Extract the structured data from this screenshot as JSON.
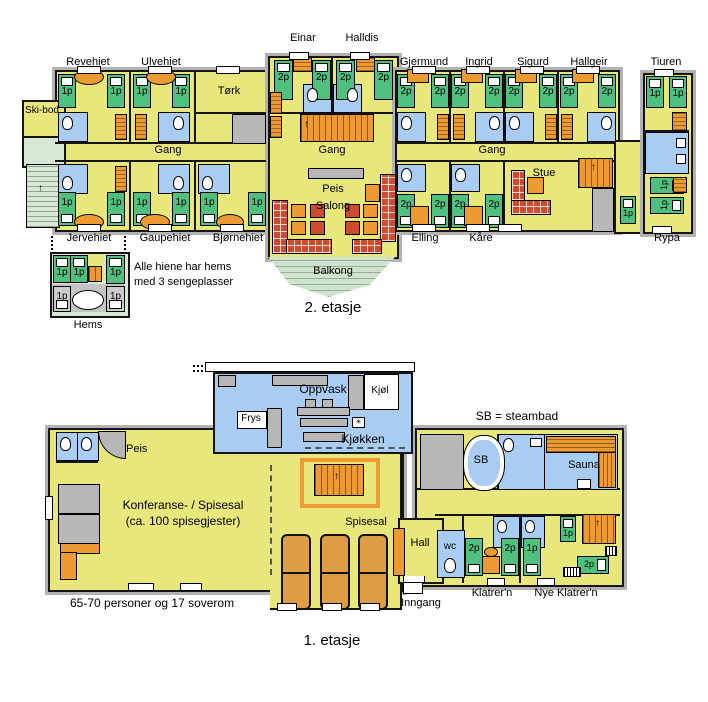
{
  "beds": {
    "p1": "1p",
    "p2": "2p"
  },
  "icons": {
    "up_arrow": "↑",
    "vent": "✳"
  },
  "floor2": {
    "title": "2. etasje",
    "rooms": {
      "revehiet": "Revehiet",
      "ulvehiet": "Ulvehiet",
      "einar": "Einar",
      "halldis": "Halldis",
      "gjermund": "Gjermund",
      "ingrid": "Ingrid",
      "sigurd": "Sigurd",
      "hallgeir": "Hallgeir",
      "tiuren": "Tiuren",
      "jervehiet": "Jervehiet",
      "gaupehiet": "Gaupehiet",
      "bjornehiet": "Bjørnehiet",
      "elling": "Elling",
      "kaare": "Kåre",
      "rypa": "Rypa",
      "skibod": "Ski-bod",
      "tork": "Tørk",
      "gang": "Gang",
      "peis": "Peis",
      "salong": "Salong",
      "stue": "Stue",
      "balkong": "Balkong",
      "hems": "Hems"
    },
    "note_line1": "Alle hiene har hems",
    "note_line2": "med 3 sengeplasser"
  },
  "floor1": {
    "title": "1. etasje",
    "rooms": {
      "oppvask": "Oppvask",
      "kjoel": "Kjøl",
      "frys": "Frys",
      "kjoekken": "Kjøkken",
      "peis": "Peis",
      "sb": "SB",
      "sauna": "Sauna",
      "konferanse1": "Konferanse- / Spisesal",
      "konferanse2": "(ca. 100 spisegjester)",
      "spisesal": "Spisesal",
      "hall": "Hall",
      "wc": "wc",
      "klatrern": "Klatrer'n",
      "nye_klatrern": "Nye Klatrer'n",
      "inngang": "Inngang"
    },
    "legend": "SB = steambad",
    "note": "65-70 personer og 17 soverom"
  },
  "colors": {
    "room_yellow": "#e7e77c",
    "bed_green": "#4fc07d",
    "bath_blue": "#a9cdf2",
    "furniture_orange": "#ee9a33",
    "sofa_red": "#cd4b2e",
    "outdoor_green": "#d5e8d2",
    "wall_gray": "#b3b3b3",
    "table_tan": "#de9c44"
  }
}
